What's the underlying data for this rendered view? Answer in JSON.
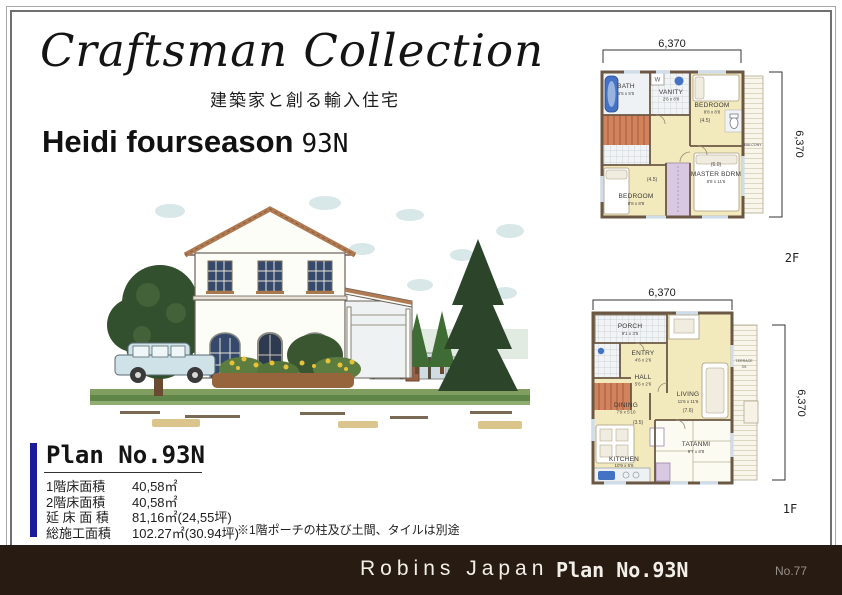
{
  "header": {
    "collection_title": "Craftsman Collection",
    "collection_subtitle": "建築家と創る輸入住宅",
    "model_name": "Heidi fourseason",
    "model_code": "93N"
  },
  "plan_box": {
    "title": "Plan No.93N",
    "accent_color": "#1b1b99",
    "rows": [
      {
        "label": "1階床面積",
        "value": "40,58㎡"
      },
      {
        "label": "2階床面積",
        "value": "40,58㎡"
      },
      {
        "label": "延 床 面 積",
        "value": "81,16㎡(24,55坪)"
      },
      {
        "label": "総施工面積",
        "value": "102.27㎡(30.94坪)"
      }
    ],
    "note": "※1階ポーチの柱及び土間、タイルは別途"
  },
  "plans": {
    "room_fill": "#f2e9bd",
    "stair_fill": "#d2825c",
    "closet_fill": "#d9c8e2",
    "wall_color": "#6b5844",
    "f2": {
      "floor_label": "2F",
      "dim_top": "6,370",
      "dim_right": "6,370",
      "rooms": {
        "bath": {
          "name": "BATH",
          "size": "5'5 x 5'5"
        },
        "vanity": {
          "name": "VANITY",
          "size": "2'6 x 8'8"
        },
        "washer": {
          "label": "W"
        },
        "bedroom_a": {
          "name": "BEDROOM",
          "size": "8'8 x 8'8",
          "mats": "(4.5)"
        },
        "bedroom_b": {
          "name": "BEDROOM",
          "size": "8'8 x 8'8",
          "mats": "(4.5)"
        },
        "master": {
          "name": "MASTER BDRM",
          "size": "8'8 x 11'6",
          "mats": "(6.0)"
        },
        "balcony": {
          "name": "BALCONY"
        }
      }
    },
    "f1": {
      "floor_label": "1F",
      "dim_top": "6,370",
      "dim_right": "6,370",
      "rooms": {
        "porch": {
          "name": "PORCH",
          "size": "9'1 x 3'5"
        },
        "entry": {
          "name": "ENTRY",
          "size": "4'6 x 2'6"
        },
        "hall": {
          "name": "HALL",
          "size": "5'6 x 2'6"
        },
        "living": {
          "name": "LIVING",
          "size": "11'6 x 11'6",
          "mats": "(7.6)"
        },
        "dining": {
          "name": "DINING",
          "size": "7'9 x 5'10",
          "mats": "(3.5)"
        },
        "kitchen": {
          "name": "KITCHEN",
          "size": "10'9 x 5'6"
        },
        "tatami": {
          "name": "TATANMI",
          "size": "9'7 x 8'8"
        },
        "terrace": {
          "name": "TERRACE",
          "size": "3'6"
        }
      }
    }
  },
  "footer": {
    "bar_color": "#281b12",
    "company": "Robins Japan",
    "plan_label": "Plan No.93N",
    "page_number": "No.77"
  }
}
